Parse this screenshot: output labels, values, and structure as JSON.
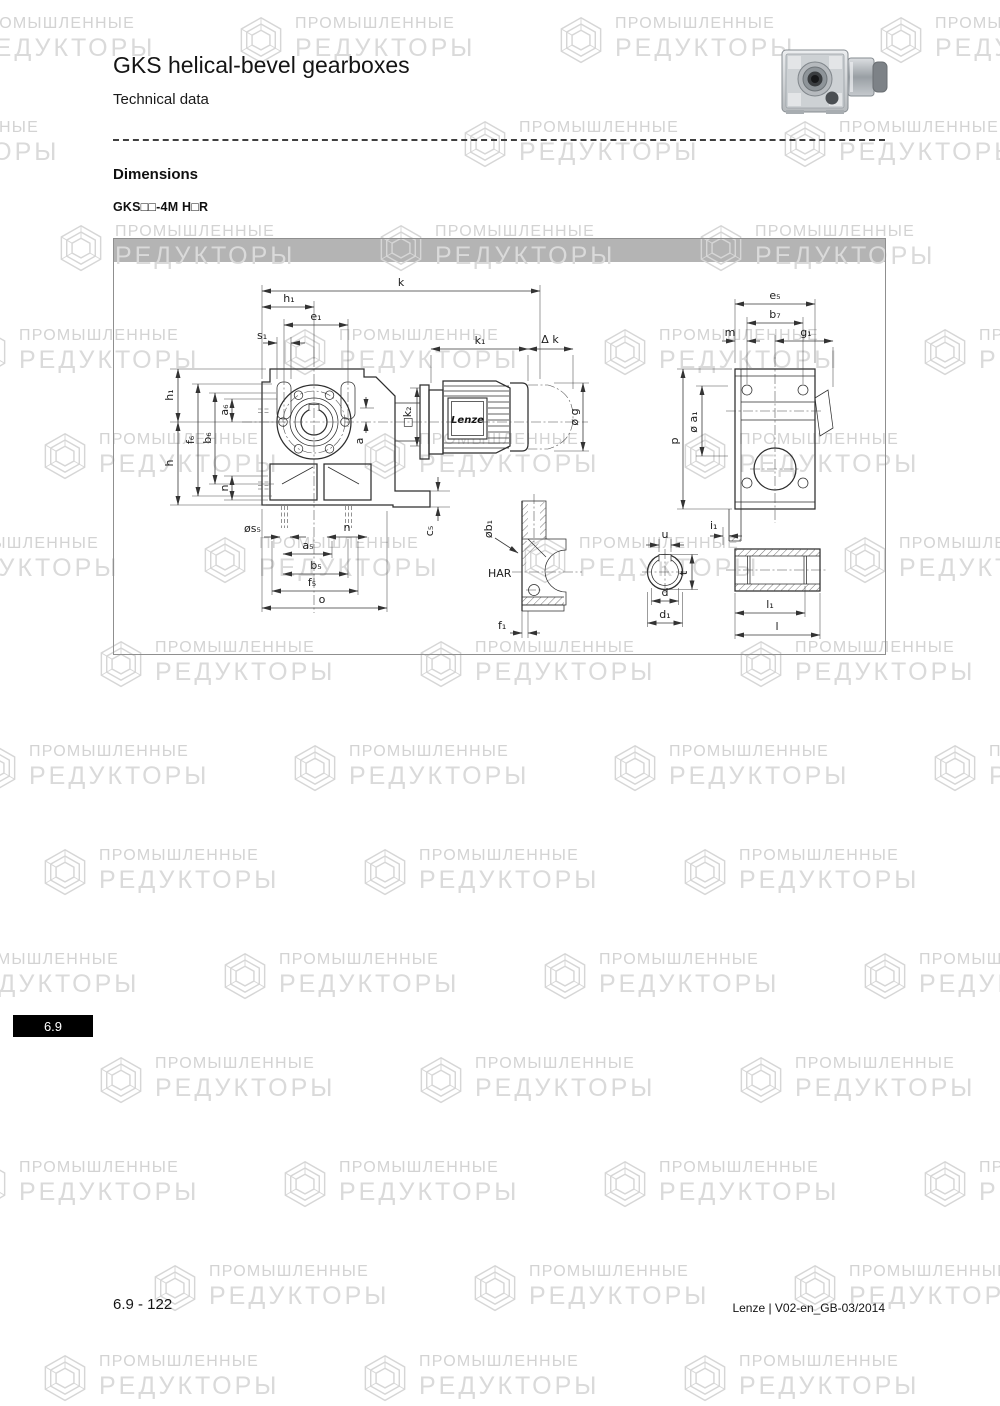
{
  "header": {
    "title": "GKS helical-bevel gearboxes",
    "subtitle": "Technical data"
  },
  "section": {
    "heading": "Dimensions",
    "model_code": "GKS□□-4M H□R"
  },
  "watermark": {
    "line1": "ПРОМЫШЛЕННЫЕ",
    "line2": "РЕДУКТОРЫ"
  },
  "drawing": {
    "motor_logo": "Lenze",
    "labels": {
      "k": "k",
      "h1": "h₁",
      "e1": "e₁",
      "s1": "s₁",
      "k1": "k₁",
      "dk": "Δ k",
      "g": "ø g",
      "h": "h",
      "f6": "f₆",
      "b6": "b₆",
      "a6": "a₆",
      "n_left": "n",
      "a": "a",
      "k2": "□k₂",
      "s5": "øs₅",
      "n_bottom": "n",
      "a5": "a₅",
      "b5": "b₅",
      "f5": "f₅",
      "o": "o",
      "c5": "c₅",
      "b1": "øb₁",
      "har": "HAR",
      "f1": "f₁",
      "e5": "e₅",
      "b7": "b₇",
      "m": "m",
      "g1": "g₁",
      "p": "p",
      "a1": "ø a₁",
      "i1": "i₁",
      "u": "u",
      "t": "t",
      "d": "d",
      "d1": "d₁",
      "l1": "l₁",
      "l": "l"
    }
  },
  "sidebar_tab": {
    "label": "6.9"
  },
  "footer": {
    "left": "6.9 - 122",
    "right": "Lenze | V02-en_GB-03/2014"
  }
}
